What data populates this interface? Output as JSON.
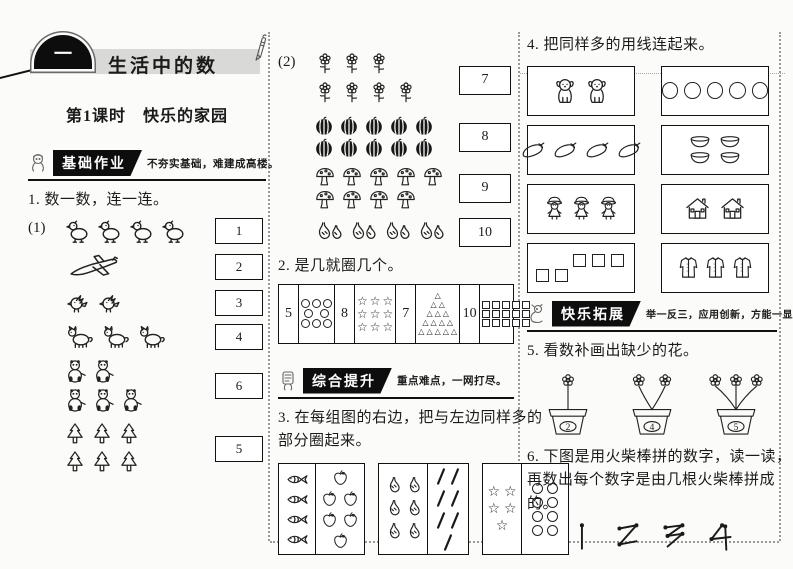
{
  "header": {
    "unit_badge": "一",
    "unit_title": "生活中的数",
    "lesson_title": "第1课时　快乐的家园"
  },
  "sections": {
    "basic": {
      "label": "基础作业",
      "slogan": "不夯实基础，难建成高楼。"
    },
    "comprehensive": {
      "label": "综合提升",
      "slogan": "重点难点，一网打尽。"
    },
    "expansion": {
      "label": "快乐拓展",
      "slogan": "举一反三，应用创新，方能一显身手！"
    }
  },
  "ex1": {
    "title": "1. 数一数，连一连。",
    "part1_label": "(1)",
    "part1_rows": [
      {
        "icon": "duck-icon",
        "lines": [
          4
        ],
        "box": "1"
      },
      {
        "icon": "airplane-icon",
        "lines": [
          1
        ],
        "box": "2"
      },
      {
        "icon": "bird-icon",
        "lines": [
          2
        ],
        "box": "3"
      },
      {
        "icon": "fox-icon",
        "lines": [
          3
        ],
        "box": "4"
      },
      {
        "icon": "panda-icon",
        "lines": [
          2,
          3
        ],
        "box": "6"
      },
      {
        "icon": "tree-icon",
        "lines": [
          3,
          3
        ],
        "box": "5"
      }
    ],
    "part2_label": "(2)",
    "part2_rows": [
      {
        "icon": "flower-icon",
        "lines": [
          3,
          4
        ],
        "box": "7"
      },
      {
        "icon": "watermelon-icon",
        "lines": [
          5,
          5
        ],
        "box": "8"
      },
      {
        "icon": "mushroom-icon",
        "lines": [
          5,
          4
        ],
        "box": "9"
      },
      {
        "icon": "pear-pair-icon",
        "lines": [
          4
        ],
        "box": "10"
      }
    ]
  },
  "ex2": {
    "title": "2. 是几就圈几个。",
    "cells": [
      {
        "number": "5",
        "shape": "circle",
        "rows": [
          3,
          2,
          3
        ]
      },
      {
        "number": "8",
        "shape": "star",
        "rows": [
          3,
          3,
          3
        ]
      },
      {
        "number": "7",
        "shape": "triangle",
        "rows": [
          1,
          2,
          3,
          4,
          5
        ]
      },
      {
        "number": "10",
        "shape": "square",
        "rows": [
          5,
          5,
          5
        ]
      }
    ]
  },
  "ex3": {
    "title_lines": [
      "3. 在每组图的右边，把与左边同样多的",
      "部分圈起来。"
    ],
    "groups": [
      {
        "left": {
          "icon": "fish-icon",
          "lines": [
            1,
            1,
            1,
            1
          ]
        },
        "right": {
          "icon": "apple-icon",
          "lines": [
            1,
            2,
            2,
            1
          ]
        }
      },
      {
        "left": {
          "icon": "pear-icon",
          "lines": [
            2,
            2,
            2
          ]
        },
        "right": {
          "icon": "stick-icon",
          "lines": [
            2,
            2,
            2,
            1
          ]
        }
      },
      {
        "left": {
          "icon": "star-icon",
          "lines": [
            2,
            2,
            1
          ]
        },
        "right": {
          "icon": "circle-icon",
          "lines": [
            2,
            2,
            2,
            2
          ]
        }
      }
    ]
  },
  "ex4": {
    "title": "4. 把同样多的用线连起来。",
    "left_boxes": [
      {
        "icon": "dog-icon",
        "lines": [
          2
        ]
      },
      {
        "icon": "eggplant-icon",
        "lines": [
          4
        ]
      },
      {
        "icon": "girl-icon",
        "lines": [
          3
        ]
      },
      {
        "icon": "square-icon",
        "lines": [
          3,
          2
        ]
      }
    ],
    "right_boxes": [
      {
        "icon": "circle-icon",
        "lines": [
          5
        ]
      },
      {
        "icon": "bowl-icon",
        "lines": [
          2,
          2
        ]
      },
      {
        "icon": "house-icon",
        "lines": [
          2
        ]
      },
      {
        "icon": "coat-icon",
        "lines": [
          3
        ]
      }
    ]
  },
  "ex5": {
    "title": "5. 看数补画出缺少的花。",
    "pots": [
      {
        "label": "2",
        "flowers": 1
      },
      {
        "label": "4",
        "flowers": 2
      },
      {
        "label": "5",
        "flowers": 3
      }
    ]
  },
  "ex6": {
    "title_lines": [
      "6. 下图是用火柴棒拼的数字，读一读，",
      "再数出每个数字是由几根火柴棒拼成",
      "的。"
    ],
    "digits": [
      "1",
      "2",
      "3",
      "4"
    ]
  }
}
